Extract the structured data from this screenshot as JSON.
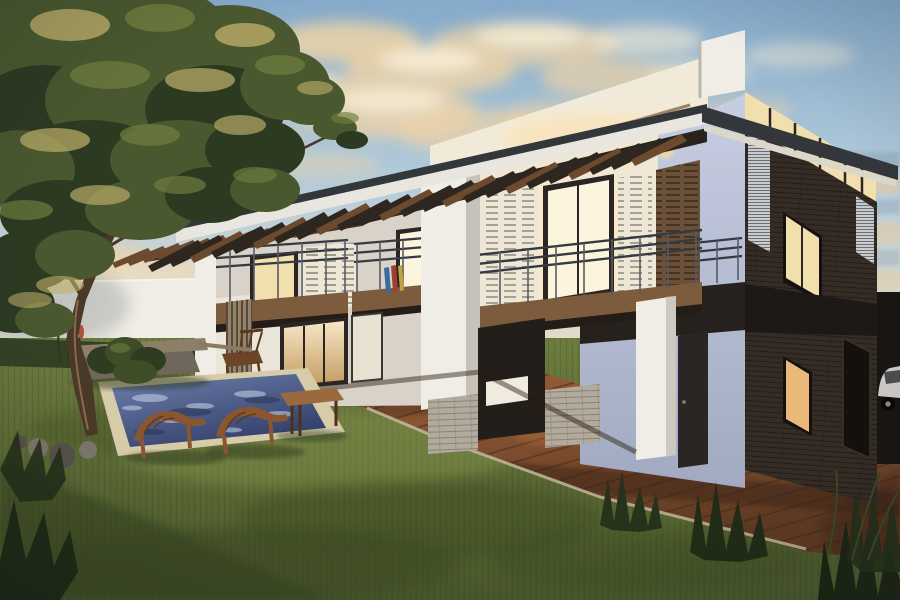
{
  "scene": {
    "type": "architectural-exterior-render",
    "description": "Dusk 3D rendering of a modern two-storey house with a slanted mono-pitch roof and exposed timber pergola rafters, steel balcony railings, glowing windows, dark brick side facade, wooden deck, green lawn, sunken mosaic pool with two curved wooden loungers, a low bench, a small wooden table, and a large olive tree on the left against a cloud-dappled sky",
    "time_of_day": "dusk",
    "elements": {
      "sky": "gradient sky with golden scattered clouds and dusk bands at right horizon",
      "tree": "large olive tree with slanted trunk, upper-left",
      "boundary_wall": "plain light garden wall on the left",
      "house": "two-storey modern villa with pergola roof, three balconies, glass gable, dark brick side wing",
      "pergola": "rows of dark timber rafters under the white roof fascia",
      "lights": "four warm downlights glowing under the eaves",
      "deck": "diagonal hardwood deck along the house base",
      "lawn": "grass garden with long evening shadows",
      "pool": "sunken rectangular pool with stone coping and blue mosaic water",
      "loungers": "two curved wooden sun loungers at the pool edge",
      "bench": "low concrete-and-wood bench by the wall",
      "table": "small wooden garden table",
      "car": "glimpse of a white car behind the right corner"
    }
  },
  "colors": {
    "skyTop": "#85aac9",
    "skyMid": "#b6cddc",
    "skyLow": "#dcd9cc",
    "skyHorizon": "#ecddc6",
    "cloudGold": "#eed3a6",
    "cloudLight": "#f8ecd4",
    "duskBlue": "#8ba3b6",
    "duskWarm": "#e8c9a2",
    "wallLight": "#d6d5d1",
    "wallBright": "#f1eee5",
    "houseWhite": "#f0ede6",
    "houseShade": "#d8d2c8",
    "houseWarm": "#efe7d5",
    "blueLight": "#c7cee2",
    "blueDark": "#a2aac2",
    "brickDark": "#352c25",
    "bandDark": "#26211d",
    "timber": "#6a5038",
    "timberDark": "#4a3322",
    "rafterDark": "#2e2720",
    "rafterBrown": "#6b4a2e",
    "beamDark": "#29231e",
    "fascia": "#e9e6df",
    "roofEdge": "#33363b",
    "soffit": "#f2ead8",
    "glassWarm": "#f2dfae",
    "glassBright": "#fdf4de",
    "bulb": "#ffd27e",
    "railDark": "#343a42",
    "postGray": "#565c66",
    "slabTimber": "#7d5c3d",
    "slabShadow": "#241d17",
    "deckLight": "#a3663d",
    "deckDark": "#5f3a22",
    "deckShadow": "#3a2414",
    "grassLight": "#93a055",
    "grassMid": "#6d7c3e",
    "grassDark": "#4b592c",
    "grassShadow": "#35421f",
    "waterLight": "#6f80ac",
    "waterDark": "#323f6a",
    "sparkle": "#c9d4ea",
    "waveDark": "#2c3858",
    "coping": "#d7cca9",
    "stoneLight": "#7c766a",
    "stoneDark": "#57524a",
    "trunk": "#4a3828",
    "trunkLight": "#8a6a48",
    "canopyDark": "#2c3a22",
    "canopyMid": "#49582e",
    "canopyLight": "#6e7c3d",
    "canopyGold": "#c1b06b",
    "flowerRed": "#b0503a",
    "shrubDark": "#2e3c22",
    "shrubMid": "#3e4c28",
    "benchTop": "#8d7f68",
    "benchBase": "#6f675c",
    "tableWood": "#9a6a3e",
    "loungerWood": "#8a5630",
    "tuftDark": "#243018",
    "carBody": "#d7d4cf",
    "wheelDark": "#0a0908",
    "louverLight": "#c9ccce",
    "screenSlat": "#93836a",
    "doorDark": "#2b2623",
    "counterWhite": "#f0ebdf",
    "wainscot": "#b2aa9c",
    "interiorDark": "#231e1a",
    "boardBlue": "#3a6aa0",
    "boardRed": "#a04030",
    "boardTan": "#c8a040",
    "doorGlassTop": "#f6e7c6",
    "doorGlassBot": "#c49a62"
  }
}
